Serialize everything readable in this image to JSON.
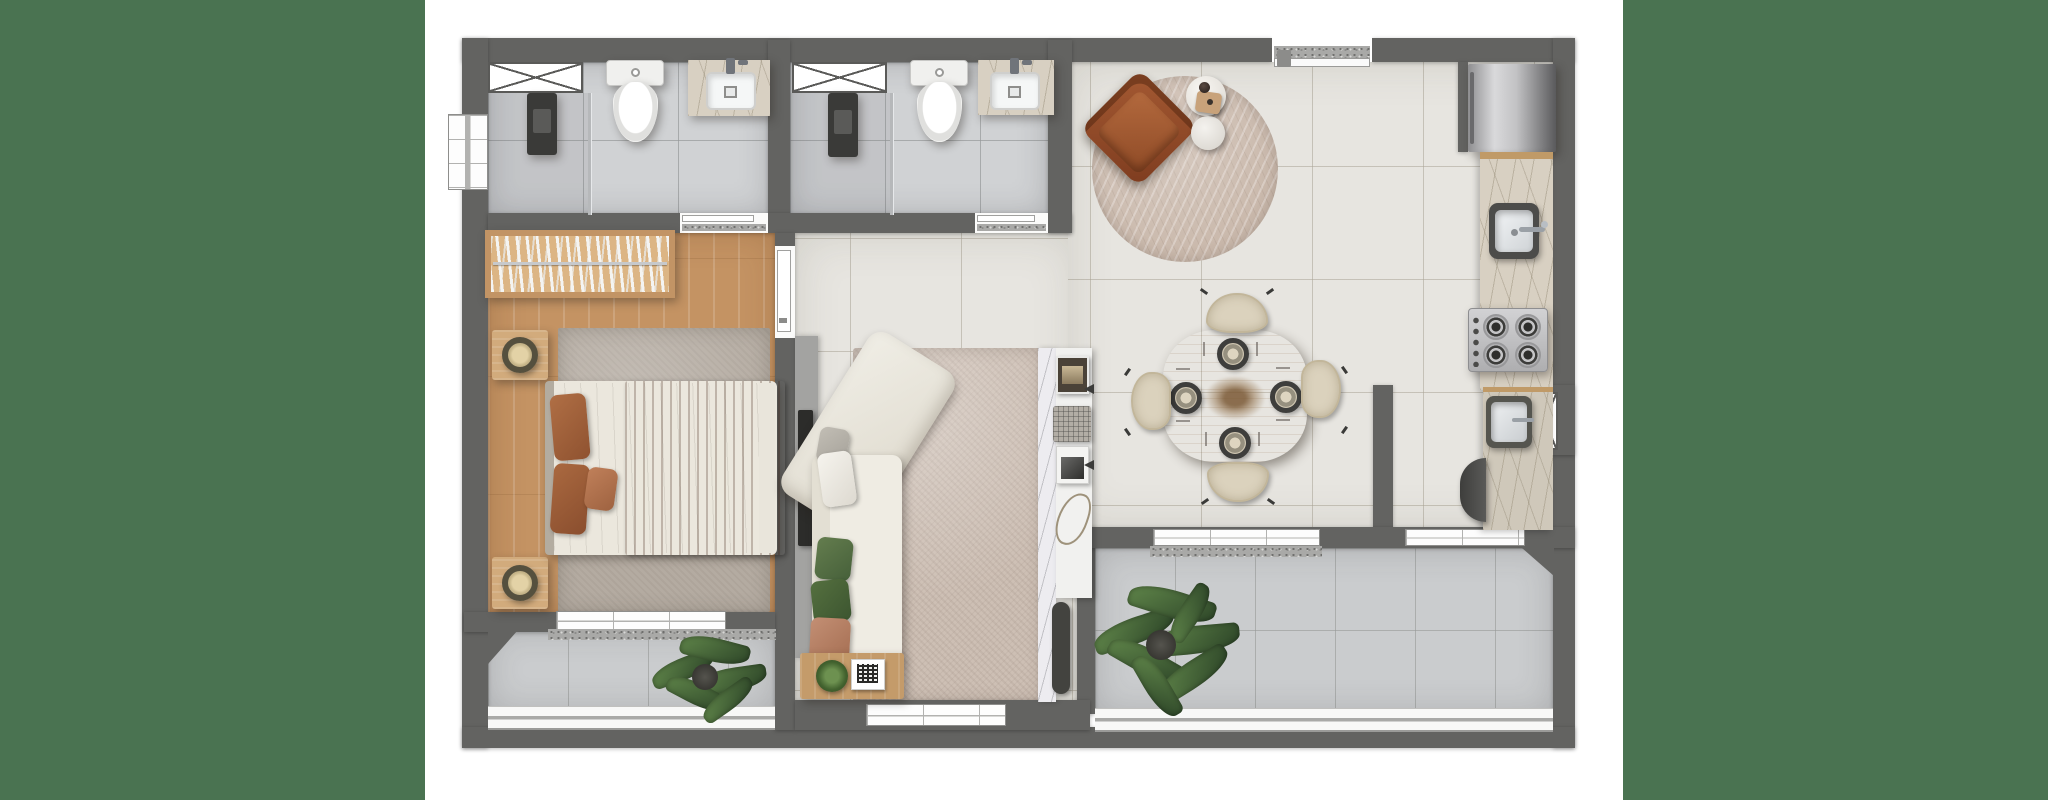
{
  "scene": {
    "kind": "architectural-floor-plan",
    "style": "top-down furnished 3D render, one-bedroom apartment",
    "visible_text": "none"
  },
  "palette": {
    "page_background": "#ffffff",
    "side_panel_green": "#4a7351",
    "wall_gray": "#636361",
    "interior_tile_beige": "#e7e5e0",
    "balcony_tile_gray": "#caccce",
    "bathroom_tile_gray": "#d0d2d4",
    "bedroom_wood": "#c49363",
    "counter_marble": "#d8d0c2",
    "console_marble_white": "#edecf0",
    "sofa_cream": "#edebe2",
    "accent_terracotta": "#a8643e",
    "armchair_sienna": "#9d5130",
    "dining_wood": "#c89d6b",
    "plant_green": "#4c6b3c",
    "railing_white": "#f8f8f7"
  },
  "layout": {
    "side_panels": {
      "left_x_range": "0-425",
      "right_x_range": "1623-2048",
      "full_height": true
    },
    "plan_bounds": {
      "x": "462-1575",
      "y": "33-748"
    }
  },
  "rooms": [
    {
      "name": "bathroom-1-ensuite",
      "floor": "gray ceramic tile",
      "items": [
        "ventilation-shaft",
        "side-window",
        "shower-column",
        "glass-partition",
        "toilet",
        "marble-vanity-sink",
        "door-to-bedroom"
      ]
    },
    {
      "name": "bathroom-2",
      "floor": "gray ceramic tile",
      "items": [
        "ventilation-shaft",
        "shower-column",
        "glass-partition",
        "toilet",
        "marble-vanity-sink",
        "door-to-hall"
      ]
    },
    {
      "name": "bedroom",
      "floor": "light wood planks",
      "items": [
        "headboard-bookshelf",
        "double-bed-white-duvet-terracotta-throw",
        "nightstand-with-lamp",
        "nightstand-with-lamp",
        "gray-area-rug",
        "door",
        "sliding-window-to-balcony"
      ]
    },
    {
      "name": "living-room",
      "floor": "large beige tile",
      "items": [
        "tv-panel",
        "media-wall",
        "l-shaped-cream-sofa",
        "green-and-white-cushions",
        "wood-end-table",
        "potted-plant",
        "qr-code-card",
        "textured-area-rug",
        "marble-decor-console",
        "magazines",
        "basket",
        "bottom-window"
      ]
    },
    {
      "name": "lounge-corner",
      "floor": "large beige tile",
      "items": [
        "round-chevron-rug",
        "sienna-leather-armchair",
        "white-round-side-tables",
        "decor-tray"
      ]
    },
    {
      "name": "dining-area",
      "floor": "large beige tile",
      "items": [
        "square-round-wood-table",
        "place-setting",
        "place-setting",
        "place-setting",
        "place-setting",
        "dried-branch-centerpiece",
        "beige-chair",
        "beige-chair",
        "beige-chair",
        "beige-chair",
        "window-to-balcony"
      ]
    },
    {
      "name": "kitchen",
      "floor": "large beige tile",
      "items": [
        "refrigerator",
        "marble-counter",
        "inset-sink-with-faucet",
        "four-burner-cooktop",
        "entry-door"
      ]
    },
    {
      "name": "service-area",
      "floor": "large beige tile",
      "items": [
        "marble-counter",
        "laundry-sink",
        "round-water-heater",
        "ventilation-shaft-window",
        "window-to-balcony"
      ]
    },
    {
      "name": "bedroom-balcony",
      "floor": "gray tile",
      "items": [
        "potted-plant",
        "white-railing",
        "chamfered-corner"
      ]
    },
    {
      "name": "main-balcony",
      "floor": "gray tile",
      "items": [
        "large-potted-plant",
        "white-railing",
        "chamfered-corner"
      ]
    }
  ],
  "counts": {
    "bathrooms": 2,
    "toilets": 2,
    "showers": 2,
    "sinks_total": 4,
    "dining_chairs": 4,
    "dining_place_settings": 4,
    "cooktop_burners": 4,
    "balcony_plants": 2,
    "table_plants": 1,
    "glazed_windows": 6,
    "ventilation_shafts": 3,
    "doors": 4,
    "rugs": 3,
    "nightstands": 2
  }
}
